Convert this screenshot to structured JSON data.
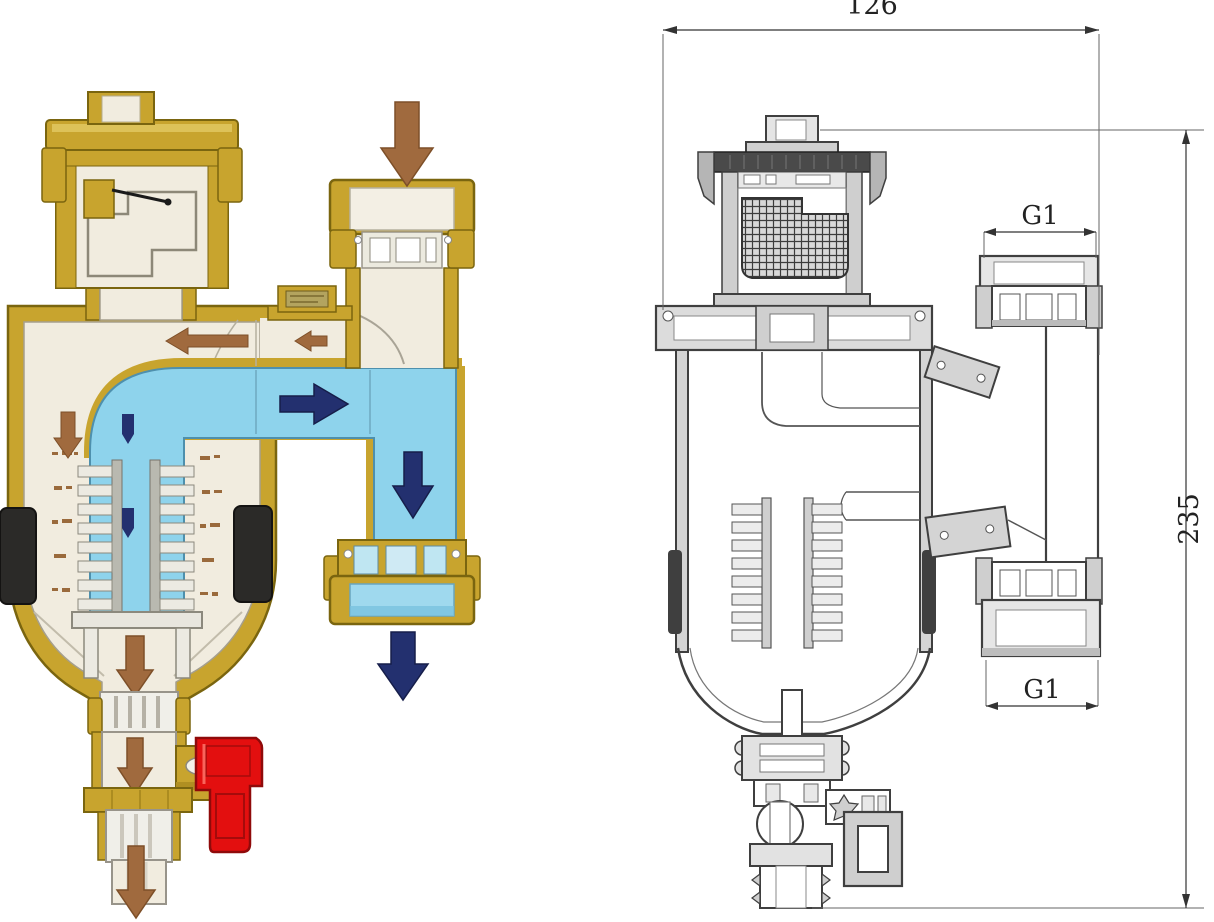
{
  "page": {
    "background": "#ffffff",
    "description": "Cutaway diagram and dimensioned cross-section drawing of a magnetic dirt separator with automatic air vent"
  },
  "cutaway": {
    "colors": {
      "brass": "#c8a42e",
      "brass_dark": "#7a650f",
      "interior": "#f1ecdf",
      "water": "#8ed3ec",
      "flow_arrow": "#23306f",
      "dirt_arrow": "#a06a3e",
      "magnet": "#2b2a28",
      "drain_handle": "#e30f0f"
    },
    "icons": [
      "inlet-down-arrow",
      "air-flow-left-arrow-large",
      "air-flow-left-arrow-small",
      "water-flow-right-arrow",
      "water-flow-down-arrow",
      "outlet-down-arrow",
      "dirt-settle-down-arrow",
      "drain-down-arrow",
      "discharge-down-arrow"
    ]
  },
  "drawing": {
    "stroke": "#3f3f3f",
    "dimensions": {
      "overall_width": "126",
      "overall_height": "235",
      "top_port": "G1",
      "bottom_port": "G1"
    }
  }
}
